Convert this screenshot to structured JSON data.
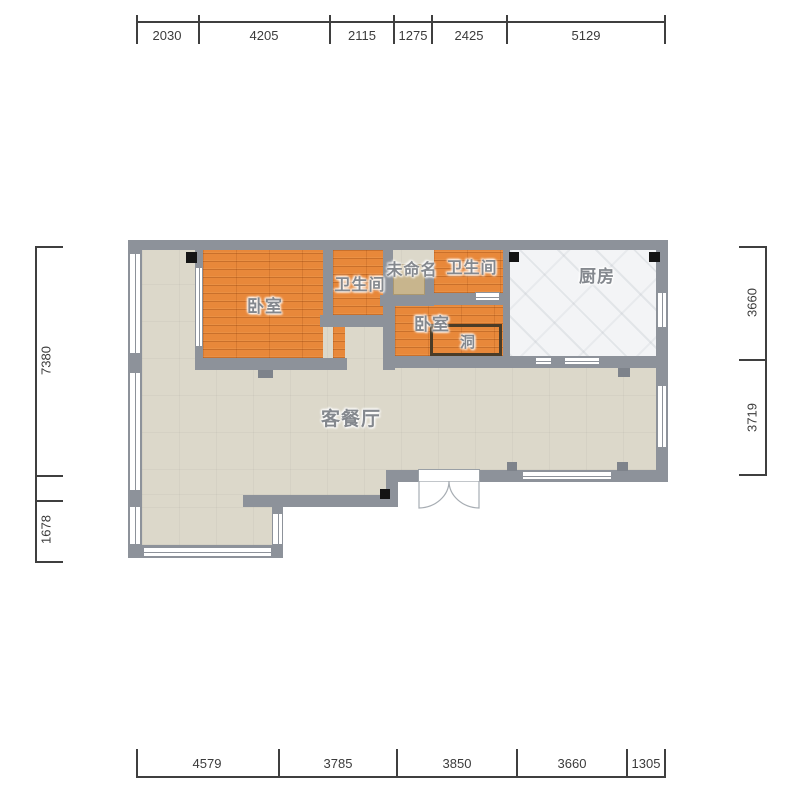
{
  "plan": {
    "rooms": {
      "bedroom_left": "卧室",
      "bathroom_left": "卫生间",
      "unnamed": "未命名",
      "bathroom_right": "卫生间",
      "kitchen": "厨房",
      "bedroom_right": "卧室",
      "hole": "洞",
      "living_dining": "客餐厅"
    }
  },
  "dims": {
    "top": [
      "2030",
      "4205",
      "2115",
      "1275",
      "2425",
      "5129"
    ],
    "bottom": [
      "4579",
      "3785",
      "3850",
      "3660",
      "1305"
    ],
    "left": [
      "7380",
      "1678"
    ],
    "right": [
      "3660",
      "3719"
    ]
  },
  "colors": {
    "wall": "#8d929a",
    "wood_floor": "#e8883a",
    "tile_floor": "#dcd8ca",
    "kitchen_floor": "#f3f4f6",
    "shaft": "#c8b58d",
    "marker": "#141414",
    "hole_border": "#4b3c27",
    "label_text": "#84888e",
    "dim_text": "#3b3b3b",
    "dim_line": "#3f3f3f"
  }
}
